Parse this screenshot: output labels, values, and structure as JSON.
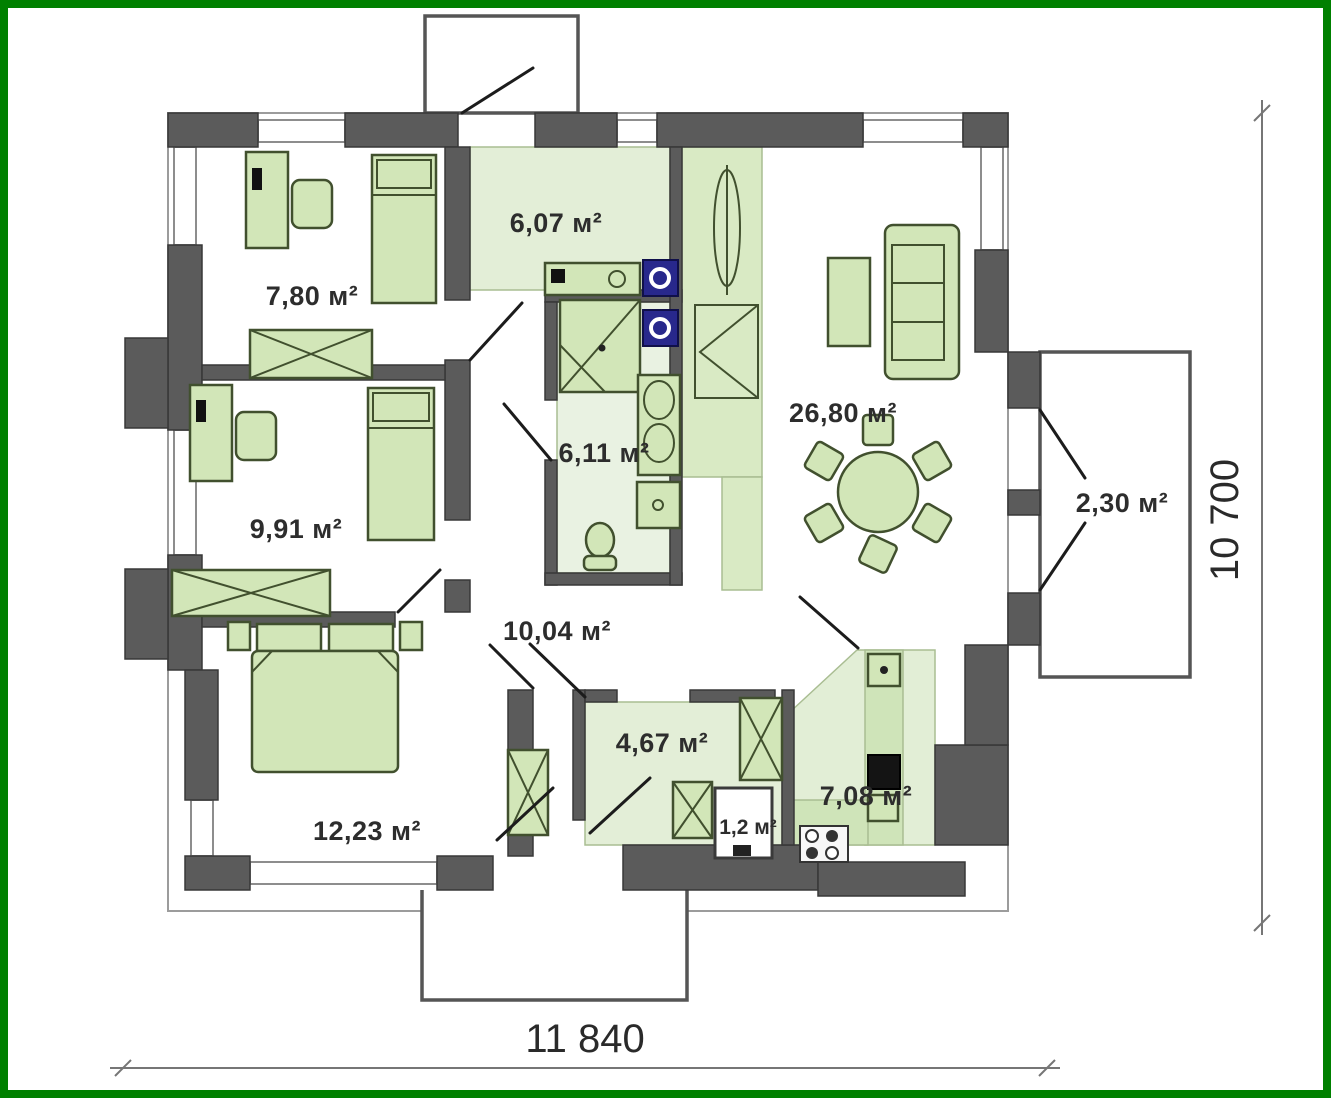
{
  "plan": {
    "type": "single-storey house floor plan",
    "area_unit": "м²"
  },
  "colors": {
    "frame_green": "#008000",
    "wall_dark": "#5b5b5b",
    "wall_light": "#8d8d8d",
    "floor_green": "#e3eed7",
    "furniture_green": "#d2e6b8",
    "accent_blue": "#28288c",
    "text": "#2d2d2d"
  },
  "rooms": {
    "hall_top": {
      "name": "hall",
      "label": "6,07 м²"
    },
    "bedroom1": {
      "name": "bedroom-1",
      "label": "7,80 м²"
    },
    "bedroom2": {
      "name": "bedroom-2",
      "label": "9,91 м²"
    },
    "bathroom": {
      "name": "bathroom",
      "label": "6,11 м²"
    },
    "living": {
      "name": "living-room",
      "label": "26,80 м²"
    },
    "terrace": {
      "name": "terrace",
      "label": "2,30 м²"
    },
    "hallway": {
      "name": "hallway",
      "label": "10,04 м²"
    },
    "vestibule": {
      "name": "vestibule",
      "label": "4,67 м²"
    },
    "wc": {
      "name": "wc",
      "label": "1,2 м²"
    },
    "kitchen": {
      "name": "kitchen",
      "label": "7,08 м²"
    },
    "bedroom3": {
      "name": "bedroom-3",
      "label": "12,23 м²"
    }
  },
  "dimensions": {
    "overall_width": "11 840",
    "overall_height": "10 700"
  }
}
